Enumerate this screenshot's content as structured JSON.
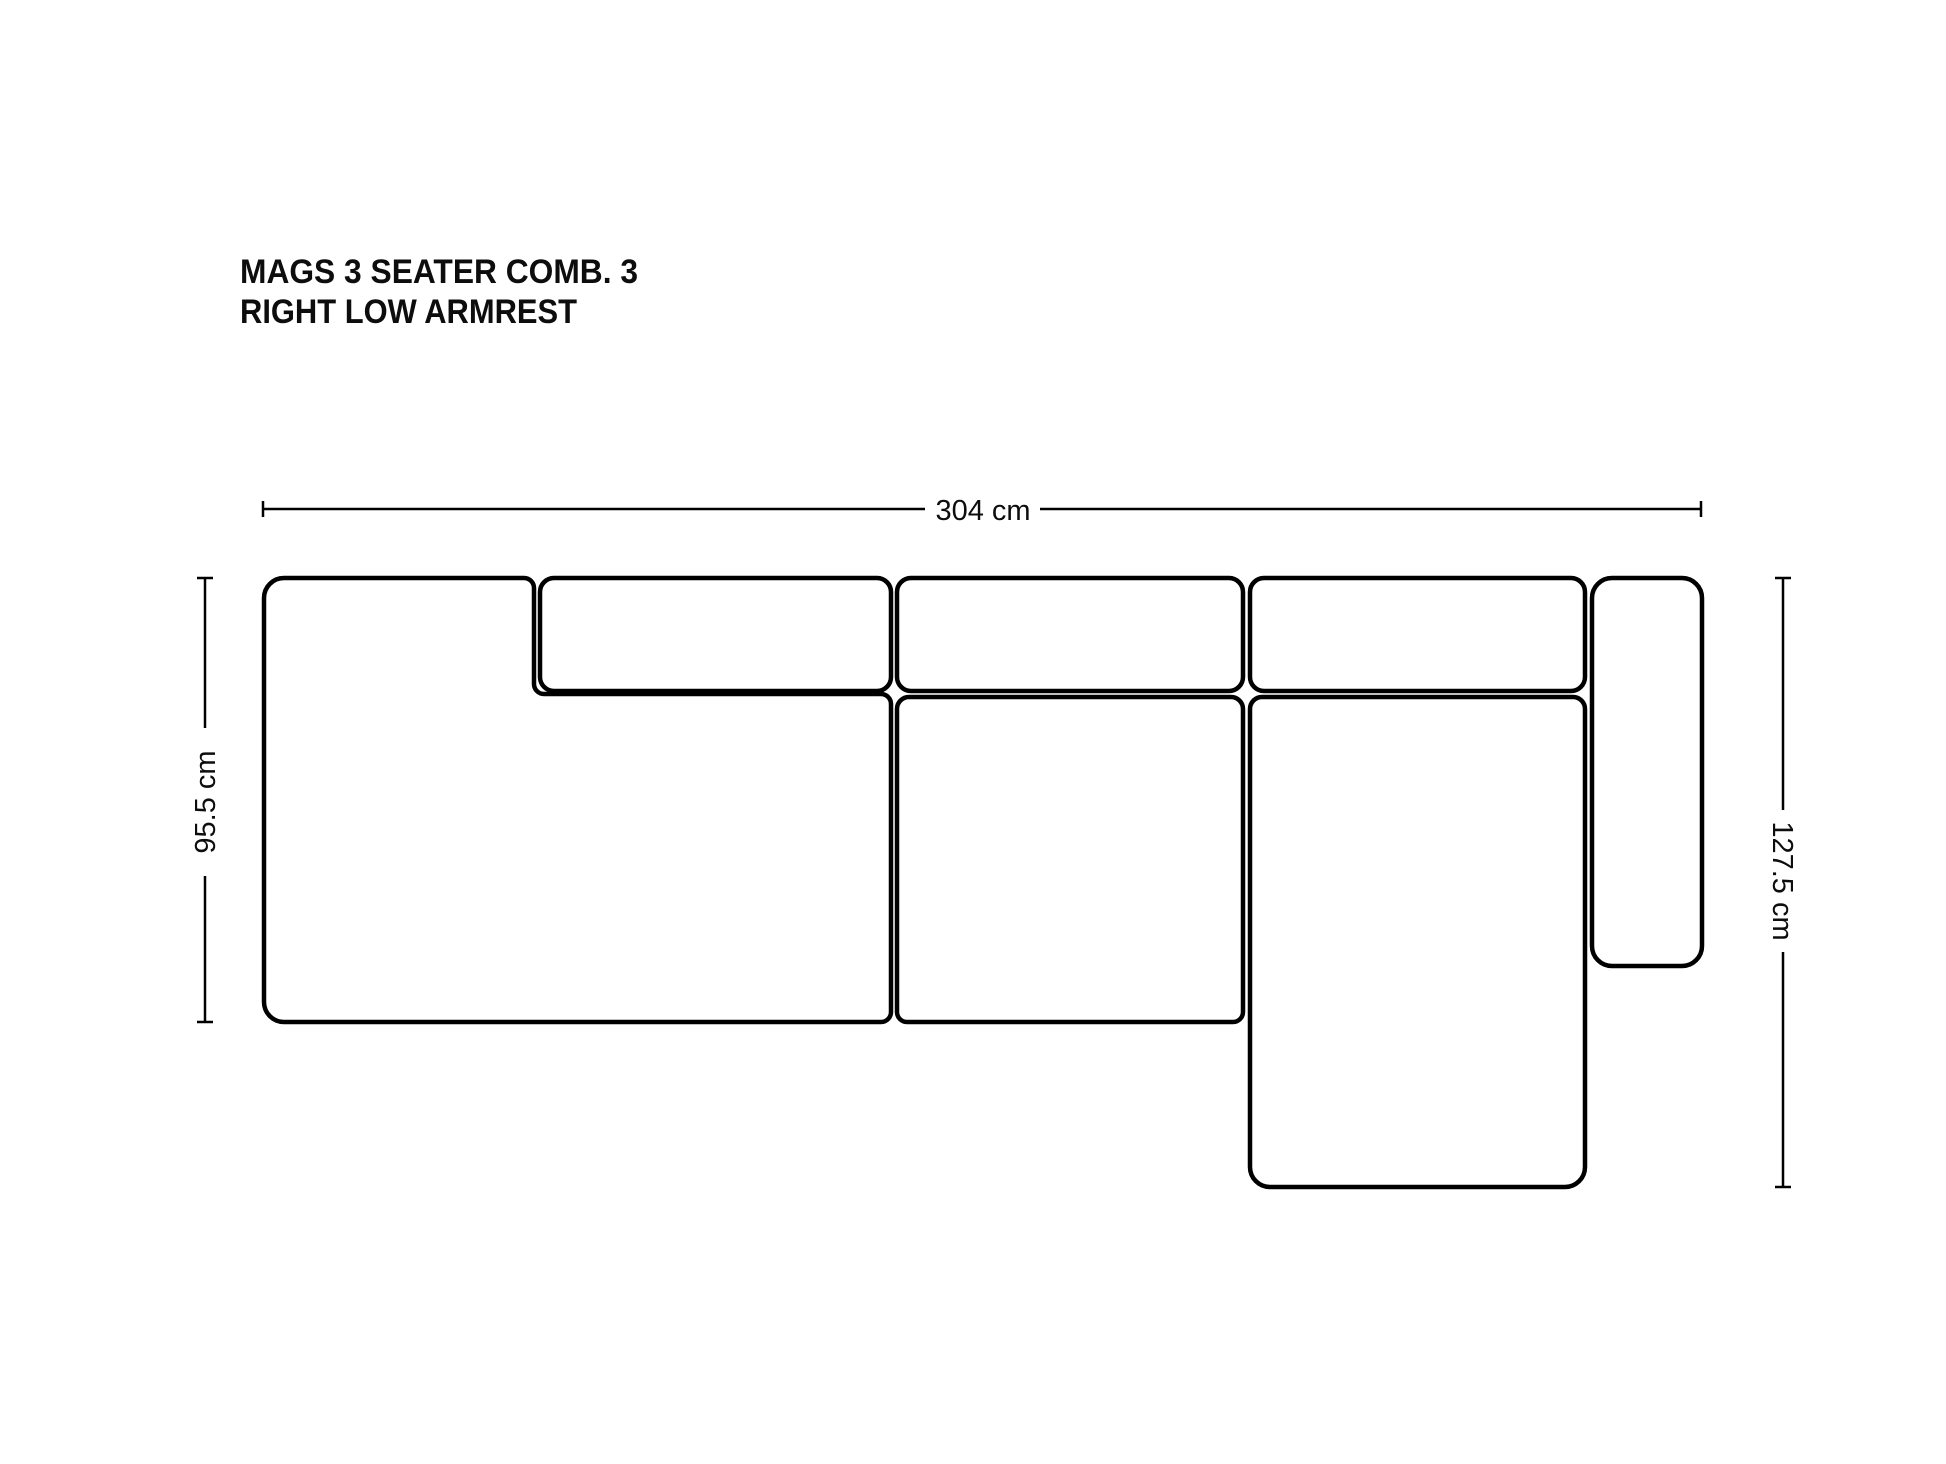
{
  "title": {
    "line1": "MAGS 3 SEATER COMB. 3",
    "line2": "RIGHT LOW ARMREST"
  },
  "dimensions": {
    "width_label": "304 cm",
    "left_depth_label": "95.5 cm",
    "right_depth_label": "127.5 cm"
  },
  "colors": {
    "background": "#ffffff",
    "line": "#000000",
    "text": "#0d0d0d"
  }
}
